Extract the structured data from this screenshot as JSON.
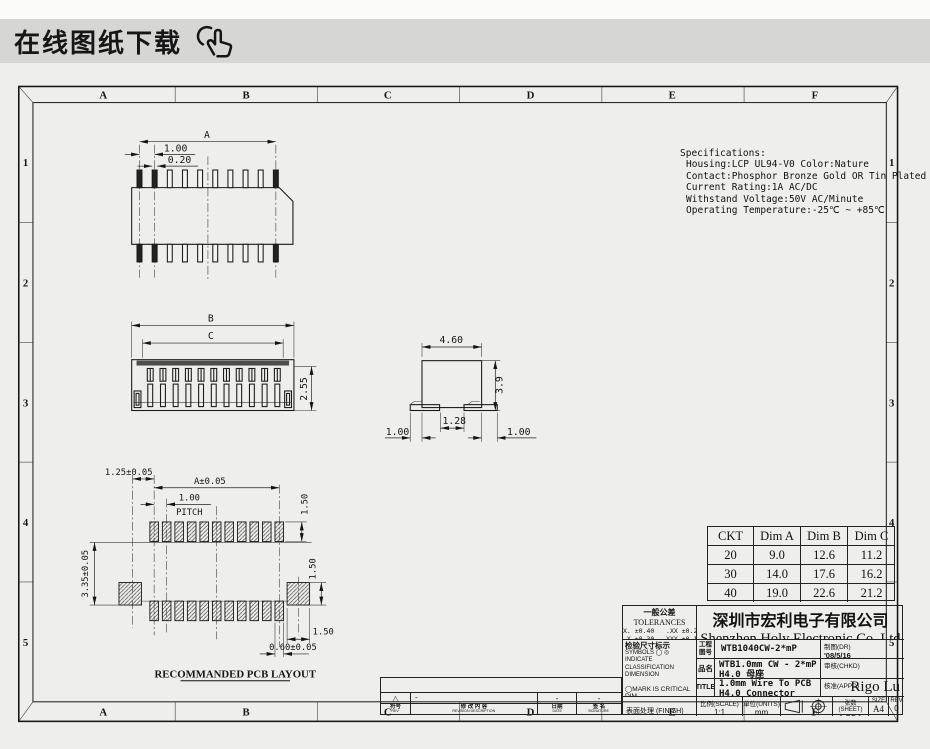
{
  "banner": {
    "title": "在线图纸下载",
    "icon": "hand-click-cursor"
  },
  "frame": {
    "cols": [
      "A",
      "B",
      "C",
      "D",
      "E",
      "F"
    ],
    "rows": [
      "1",
      "2",
      "3",
      "4",
      "5"
    ]
  },
  "specs": {
    "title": "Specifications:",
    "lines": [
      "Housing:LCP UL94-V0 Color:Nature",
      "Contact:Phosphor Bronze Gold OR Tin Plated",
      "Current Rating:1A AC/DC",
      "Withstand Voltage:50V AC/Minute",
      "Operating Temperature:-25℃ ~ +85℃"
    ]
  },
  "views": {
    "top": {
      "a": "A",
      "pitch": "1.00",
      "pin": "0.20"
    },
    "front": {
      "b": "B",
      "c": "C",
      "h": "2.55"
    },
    "side": {
      "w": "4.60",
      "h": "3.9",
      "gap": "1.28",
      "l": "1.00",
      "r": "1.00"
    },
    "pcb": {
      "edge": "1.25±0.05",
      "a": "A±0.05",
      "pitch": "1.00",
      "pitch_label": "PITCH",
      "pad_h": "1.50",
      "row_h": "3.35±0.05",
      "sq_h": "1.50",
      "sq_w": "1.50",
      "pad_w": "0.60±0.05",
      "label": "RECOMMANDED PCB LAYOUT"
    }
  },
  "table": {
    "headers": [
      "CKT",
      "Dim A",
      "Dim B",
      "Dim C"
    ],
    "rows": [
      [
        "20",
        "9.0",
        "12.6",
        "11.2"
      ],
      [
        "30",
        "14.0",
        "17.6",
        "16.2"
      ],
      [
        "40",
        "19.0",
        "22.6",
        "21.2"
      ]
    ]
  },
  "revision": {
    "headers": [
      {
        "cn": "符号",
        "en": "REV"
      },
      {
        "cn": "修 改 内 容",
        "en": "REVISION DESCRIPTION"
      },
      {
        "cn": "日期",
        "en": "DATE"
      },
      {
        "cn": "签 名",
        "en": "SIGNATURE"
      }
    ],
    "entry": {
      "mark": "△",
      "desc": "-",
      "date": "-",
      "sign": "-"
    }
  },
  "titleblock": {
    "tolerances": {
      "title_cn": "一般公差",
      "title_en": "TOLERANCES",
      "line1": "X. ±0.40   .XX ±0.20",
      "line2": ".X ±0.30  .XXX ±0.10",
      "line3": "ANGLES       ±2°"
    },
    "inspection": {
      "title": "检验尺寸标示",
      "sym1": "SYMBOLS ◯ ◎ INDICATE",
      "sym2": "CLASSIFICATION DIMENSION",
      "crit": "◯MARK IS CRITICAL DIM.",
      "major": "◎MARK IS MAJOR DIM."
    },
    "finish_label": "表面处理 (FINISH)",
    "company_cn": "深圳市宏利电子有限公司",
    "company_en": "Shenzhen Holy Electronic Co.,Ltd",
    "eng_label": "工程图号",
    "eng_value": "WTB1040CW-2*mP",
    "dr_label": "制图(DR)",
    "dr_value": "'08/5/16",
    "part_label": "品名",
    "part_value": "WTB1.0mm CW - 2*mP H4.0 母座",
    "chkd_label": "审核(CHKD)",
    "chkd_value": "",
    "title_label": "TITLE",
    "title_value": "1.0mm Wire To PCB H4.0 Connector",
    "appd_label": "核准(APPD)",
    "appd_value": "Rigo Lu",
    "scale_label": "比例(SCALE)",
    "scale_value": "1:1",
    "units_label": "单位(UNITS)",
    "units_value": "mm",
    "sheet_label": "张数(SHEET)",
    "sheet_value": "1 OF 1",
    "size_label": "SIZE",
    "size_value": "A4",
    "rev_label": "REV",
    "rev_value": "0"
  }
}
